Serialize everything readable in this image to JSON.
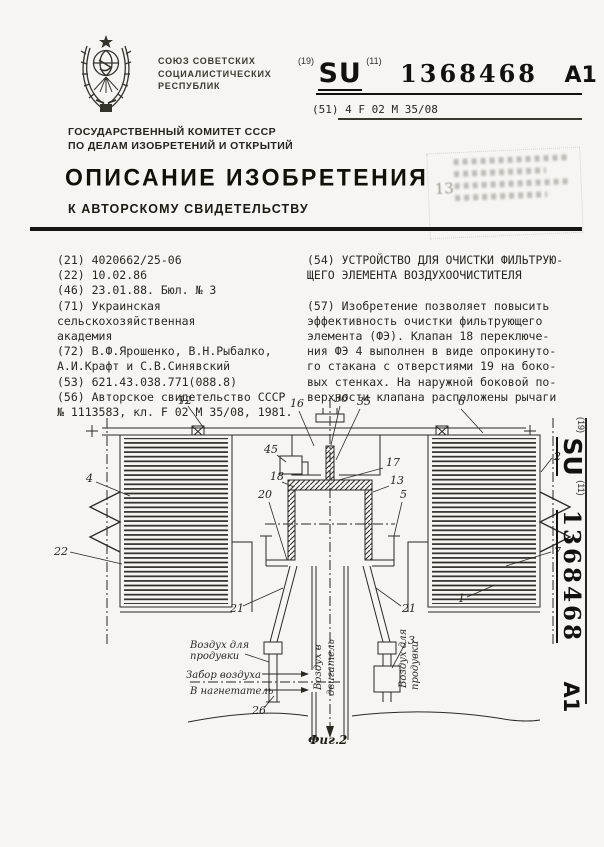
{
  "pub": {
    "code_label": "(19)",
    "code": "SU",
    "num_label": "(11)",
    "number": "1368468",
    "kind": "A1"
  },
  "header": {
    "org_lines": [
      "СОЮЗ СОВЕТСКИХ",
      "СОЦИАЛИСТИЧЕСКИХ",
      "РЕСПУБЛИК"
    ],
    "ipc": "(51) 4 F 02 M 35/08",
    "committee_lines": [
      "ГОСУДАРСТВЕННЫЙ КОМИТЕТ СССР",
      "ПО ДЕЛАМ ИЗОБРЕТЕНИЙ И ОТКРЫТИЙ"
    ],
    "title": "ОПИСАНИЕ ИЗОБРЕТЕНИЯ",
    "subtitle": "К АВТОРСКОМУ СВИДЕТЕЛЬСТВУ",
    "stamp_fragment": "13"
  },
  "biblio": {
    "left_lines": [
      "(21) 4020662/25-06",
      "(22) 10.02.86",
      "(46) 23.01.88. Бюл. № 3",
      "(71) Украинская сельскохозяйственная",
      "академия",
      "(72) В.Ф.Ярошенко, В.Н.Рыбалко,",
      "А.И.Крафт и С.В.Синявский",
      "(53) 621.43.038.771(088.8)",
      "(56) Авторское свидетельство СССР",
      "№ 1113583, кл. F 02 M 35/08, 1981."
    ],
    "right_lines": [
      "(54) УСТРОЙСТВО ДЛЯ ОЧИСТКИ ФИЛЬТРУЮ-",
      "ЩЕГО ЭЛЕМЕНТА ВОЗДУХООЧИСТИТЕЛЯ",
      "",
      "(57) Изобретение позволяет повысить",
      "эффективность очистки фильтрующего",
      "элемента (ФЭ). Клапан 18 переключе-",
      "ния ФЭ 4 выполнен в виде опрокинуто-",
      "го стакана с отверстиями 19 на боко-",
      "вых стенках. На наружной боковой по-",
      "верхности клапана расположены рычаги"
    ]
  },
  "figure": {
    "caption": "Фиг.2",
    "labels": {
      "l1": "1",
      "l2": "2",
      "l3": "3",
      "l4": "4",
      "l5": "5",
      "l6": "6",
      "l7": "7",
      "l12": "12",
      "l13": "13",
      "l16": "16",
      "l17": "17",
      "l18": "18",
      "l20": "20",
      "l21a": "21",
      "l21b": "21",
      "l22": "22",
      "l26": "26",
      "l35": "35",
      "l36": "36",
      "l45": "45"
    },
    "annotations": {
      "left_top_1": "Воздух для",
      "left_top_2": "продувки",
      "intake": "Забор воздуха",
      "supercharger": "В нагнетатель",
      "engine_1": "Воздух в",
      "engine_2": "двигатель",
      "right_1": "Воздух для",
      "right_2": "продувки"
    }
  }
}
